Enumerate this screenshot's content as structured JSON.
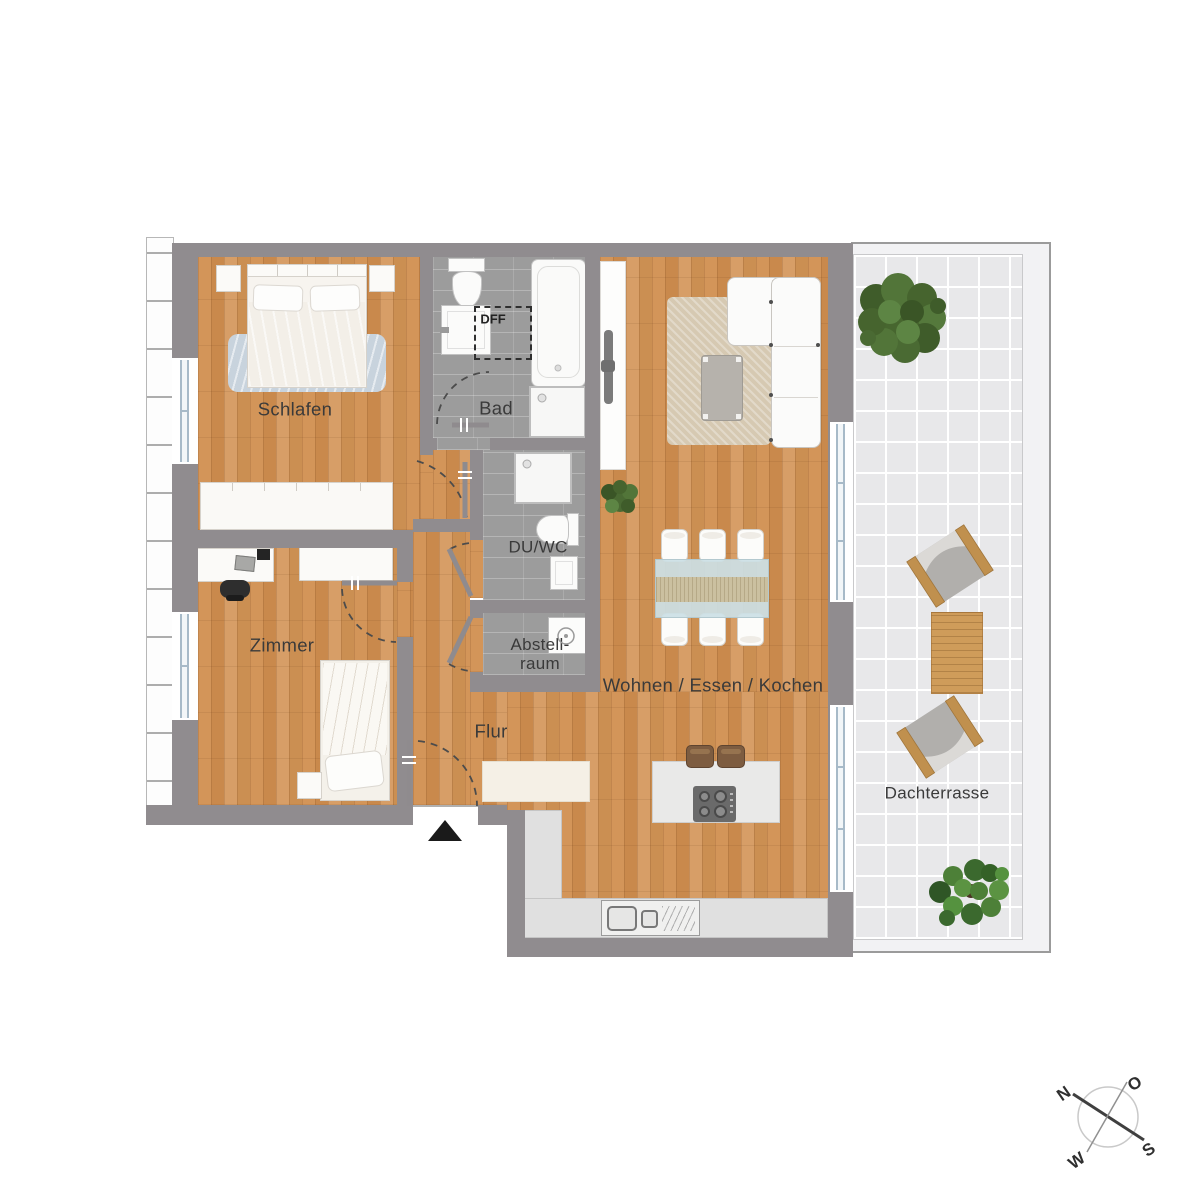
{
  "rooms": {
    "schlafen": "Schlafen",
    "bad": "Bad",
    "dff": "DFF",
    "du_wc": "DU/WC",
    "abstellraum_line1": "Abstell-",
    "abstellraum_line2": "raum",
    "zimmer": "Zimmer",
    "flur": "Flur",
    "wohnen_essen_kochen": "Wohnen / Essen / Kochen",
    "dachterrasse": "Dachterrasse"
  },
  "compass": {
    "n": "N",
    "e": "O",
    "s": "S",
    "w": "W"
  },
  "colors": {
    "wall": "#908c8f",
    "wood_floor": "#cd9154",
    "bath_tile": "#9c9c9c",
    "terrace_tile": "#e8e8ea",
    "kitchen_counter": "#e0e0e0",
    "label_text": "#3a3a3a",
    "blanket_blue": "#c8d3dd",
    "tree_green": "#4d7a38",
    "stool_brown": "#7d5c40",
    "entrance_marker": "#1a1a1a",
    "window_glass": "#a7bac8"
  }
}
